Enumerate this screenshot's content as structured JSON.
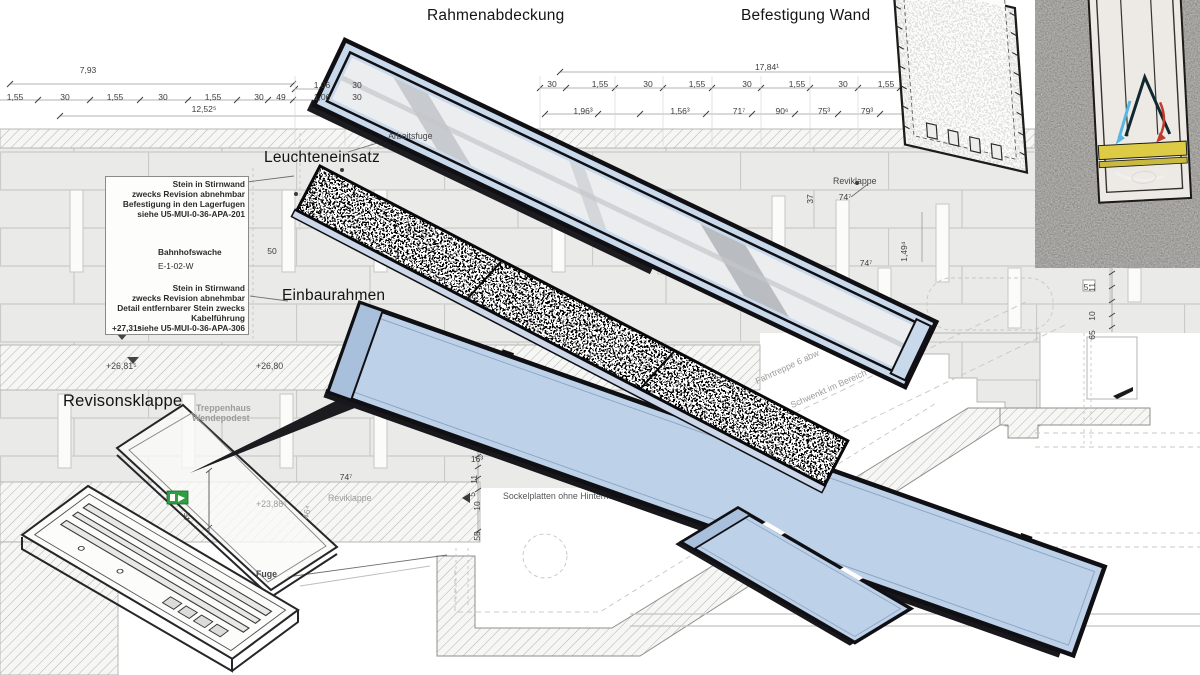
{
  "labels": {
    "rahmenabdeckung": "Rahmenabdeckung",
    "befestigung_wand": "Befestigung Wand",
    "leuchteneinsatz": "Leuchteneinsatz",
    "einbaurahmen": "Einbaurahmen",
    "revisonsklappe": "Revisonsklappe"
  },
  "note_box": {
    "note1_line1": "Stein in Stirnwand",
    "note1_line2": "zwecks Revision abnehmbar",
    "note1_line3": "Befestigung in den Lagerfugen",
    "note1_line4": "siehe U5-MUI-0-36-APA-201",
    "room_name": "Bahnhofswache",
    "room_id": "E-1-02-W",
    "note2_line1": "Stein in Stirnwand",
    "note2_line2": "zwecks Revision abnehmbar",
    "note2_line3": "Detail entfernbarer Stein zwecks",
    "note2_line4": "Kabelführung",
    "note2_line5": "siehe U5-MUI-0-36-APA-306",
    "elevation": "+27,31⁵"
  },
  "annotations_small": [
    {
      "t": "Arbeitsfuge",
      "x": 388,
      "y": 131
    },
    {
      "t": "Reviklappe",
      "x": 833,
      "y": 176
    },
    {
      "t": "Fuge",
      "x": 256,
      "y": 569,
      "b": 1
    },
    {
      "t": "+26,81⁵",
      "x": 106,
      "y": 361
    },
    {
      "t": "+26,80",
      "x": 256,
      "y": 361
    }
  ],
  "annotations_under": [
    {
      "t": "Sockelplatten ohne Hintermö",
      "x": 503,
      "y": 491,
      "c": "#55555a"
    },
    {
      "t": "Kante der Fahrtreppe erst",
      "x": 648,
      "y": 466,
      "r": -33
    },
    {
      "t": "Fahrtreppe 6 abw",
      "x": 758,
      "y": 376,
      "r": -25
    },
    {
      "t": "Schwenkt im Bereich von +/-15cm",
      "x": 793,
      "y": 400,
      "r": -24
    },
    {
      "t": "Reviklappe",
      "x": 328,
      "y": 493
    }
  ],
  "annotations_grey": [
    {
      "t": "Treppenhaus",
      "x": 196,
      "y": 403,
      "b": 1
    },
    {
      "t": "Wendepodest",
      "x": 192,
      "y": 413,
      "b": 1
    },
    {
      "t": "+23,86⁵",
      "x": 256,
      "y": 499
    },
    {
      "t": "46⁴",
      "x": 310,
      "y": 510,
      "r": -75
    }
  ],
  "dimensions": [
    {
      "t": "7,93",
      "x": 88,
      "y": 66
    },
    {
      "t": "1,55",
      "x": 15,
      "y": 93
    },
    {
      "t": "30",
      "x": 65,
      "y": 93
    },
    {
      "t": "1,55",
      "x": 115,
      "y": 93
    },
    {
      "t": "30",
      "x": 163,
      "y": 93
    },
    {
      "t": "1,55",
      "x": 213,
      "y": 93
    },
    {
      "t": "30",
      "x": 259,
      "y": 93
    },
    {
      "t": "49",
      "x": 281,
      "y": 93
    },
    {
      "t": "1,06",
      "x": 322,
      "y": 93
    },
    {
      "t": "30",
      "x": 357,
      "y": 93
    },
    {
      "t": "1,06",
      "x": 322,
      "y": 81
    },
    {
      "t": "30",
      "x": 357,
      "y": 81
    },
    {
      "t": "12,52⁵",
      "x": 204,
      "y": 105
    },
    {
      "t": "30",
      "x": 552,
      "y": 80
    },
    {
      "t": "1,55",
      "x": 600,
      "y": 80
    },
    {
      "t": "30",
      "x": 648,
      "y": 80
    },
    {
      "t": "1,55",
      "x": 697,
      "y": 80
    },
    {
      "t": "30",
      "x": 747,
      "y": 80
    },
    {
      "t": "1,55",
      "x": 797,
      "y": 80
    },
    {
      "t": "30",
      "x": 843,
      "y": 80
    },
    {
      "t": "1,55",
      "x": 886,
      "y": 80
    },
    {
      "t": "17,84¹",
      "x": 767,
      "y": 63
    },
    {
      "t": "1,96³",
      "x": 583,
      "y": 107
    },
    {
      "t": "1,56³",
      "x": 680,
      "y": 107
    },
    {
      "t": "71⁷",
      "x": 739,
      "y": 107
    },
    {
      "t": "90⁶",
      "x": 782,
      "y": 107
    },
    {
      "t": "75³",
      "x": 824,
      "y": 107
    },
    {
      "t": "79³",
      "x": 867,
      "y": 107
    },
    {
      "t": "37",
      "x": 318,
      "y": 196,
      "r": -90
    },
    {
      "t": "50",
      "x": 272,
      "y": 247
    },
    {
      "t": "37",
      "x": 816,
      "y": 194,
      "r": -90
    },
    {
      "t": "74⁷",
      "x": 845,
      "y": 193
    },
    {
      "t": "1,49⁴",
      "x": 910,
      "y": 252,
      "r": -90
    },
    {
      "t": "74⁷",
      "x": 866,
      "y": 259
    },
    {
      "t": "74⁷",
      "x": 346,
      "y": 473
    },
    {
      "t": "16³",
      "x": 477,
      "y": 455
    },
    {
      "t": "11",
      "x": 480,
      "y": 474,
      "r": -90
    },
    {
      "t": "5",
      "x": 478,
      "y": 487,
      "r": -90
    },
    {
      "t": "10",
      "x": 483,
      "y": 501,
      "r": -90
    },
    {
      "t": "55",
      "x": 483,
      "y": 531,
      "r": -90
    },
    {
      "t": "45",
      "x": 193,
      "y": 512,
      "r": -90
    },
    {
      "t": "11",
      "x": 1098,
      "y": 282,
      "r": -90
    },
    {
      "t": "5",
      "x": 1086,
      "y": 283
    },
    {
      "t": "10",
      "x": 1098,
      "y": 311,
      "r": -90
    },
    {
      "t": "65",
      "x": 1098,
      "y": 330,
      "r": -90
    }
  ],
  "colors": {
    "panel_blue": "#bdd1e9",
    "cover_blue": "#c9d9ec",
    "glass_grey": "#ecedef",
    "frame_black": "#15151a",
    "wall_tile": "#eaeae8",
    "exit_green": "#2f9e41",
    "strip_yellow": "#ddca45",
    "arrow_red": "#c23a2a",
    "arrow_blue": "#56b6e4"
  },
  "icons": {
    "exit_sign": "emergency-exit-pictogram"
  }
}
